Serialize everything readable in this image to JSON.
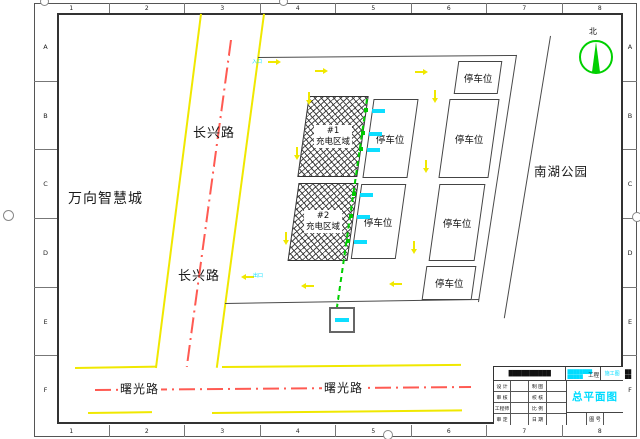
{
  "drawing": {
    "frame": {
      "columns": [
        "1",
        "2",
        "3",
        "4",
        "5",
        "6",
        "7",
        "8"
      ],
      "rows": [
        "A",
        "B",
        "C",
        "D",
        "E",
        "F"
      ]
    },
    "north_label": "北",
    "roads": {
      "changxing_name": "长兴路",
      "shuguang_name": "曙光路"
    },
    "areas": {
      "west_block": "万向智慧城",
      "east_park": "南湖公园"
    },
    "site": {
      "zone1_no": "#1",
      "zone2_no": "#2",
      "zone_label": "充电区域",
      "parking_label": "停车位",
      "entrance_label": "入口",
      "exit_label": "出口"
    },
    "title_block": {
      "company": "██████████",
      "project_line1": "████████",
      "project_line2": "█████",
      "project_suffix": "工程",
      "stage": "施工图",
      "side_note1": "██",
      "side_note2": "██",
      "drawing_title": "总平面图",
      "drawing_no_label": "图 号",
      "fields": {
        "r1c1": "设 计",
        "r1c2": "制 图",
        "r2c1": "审 核",
        "r2c2": "校 核",
        "r3c1": "工程师",
        "r3c2": "比 例",
        "r4c1": "审 定",
        "r4c2": "日 期"
      }
    }
  }
}
